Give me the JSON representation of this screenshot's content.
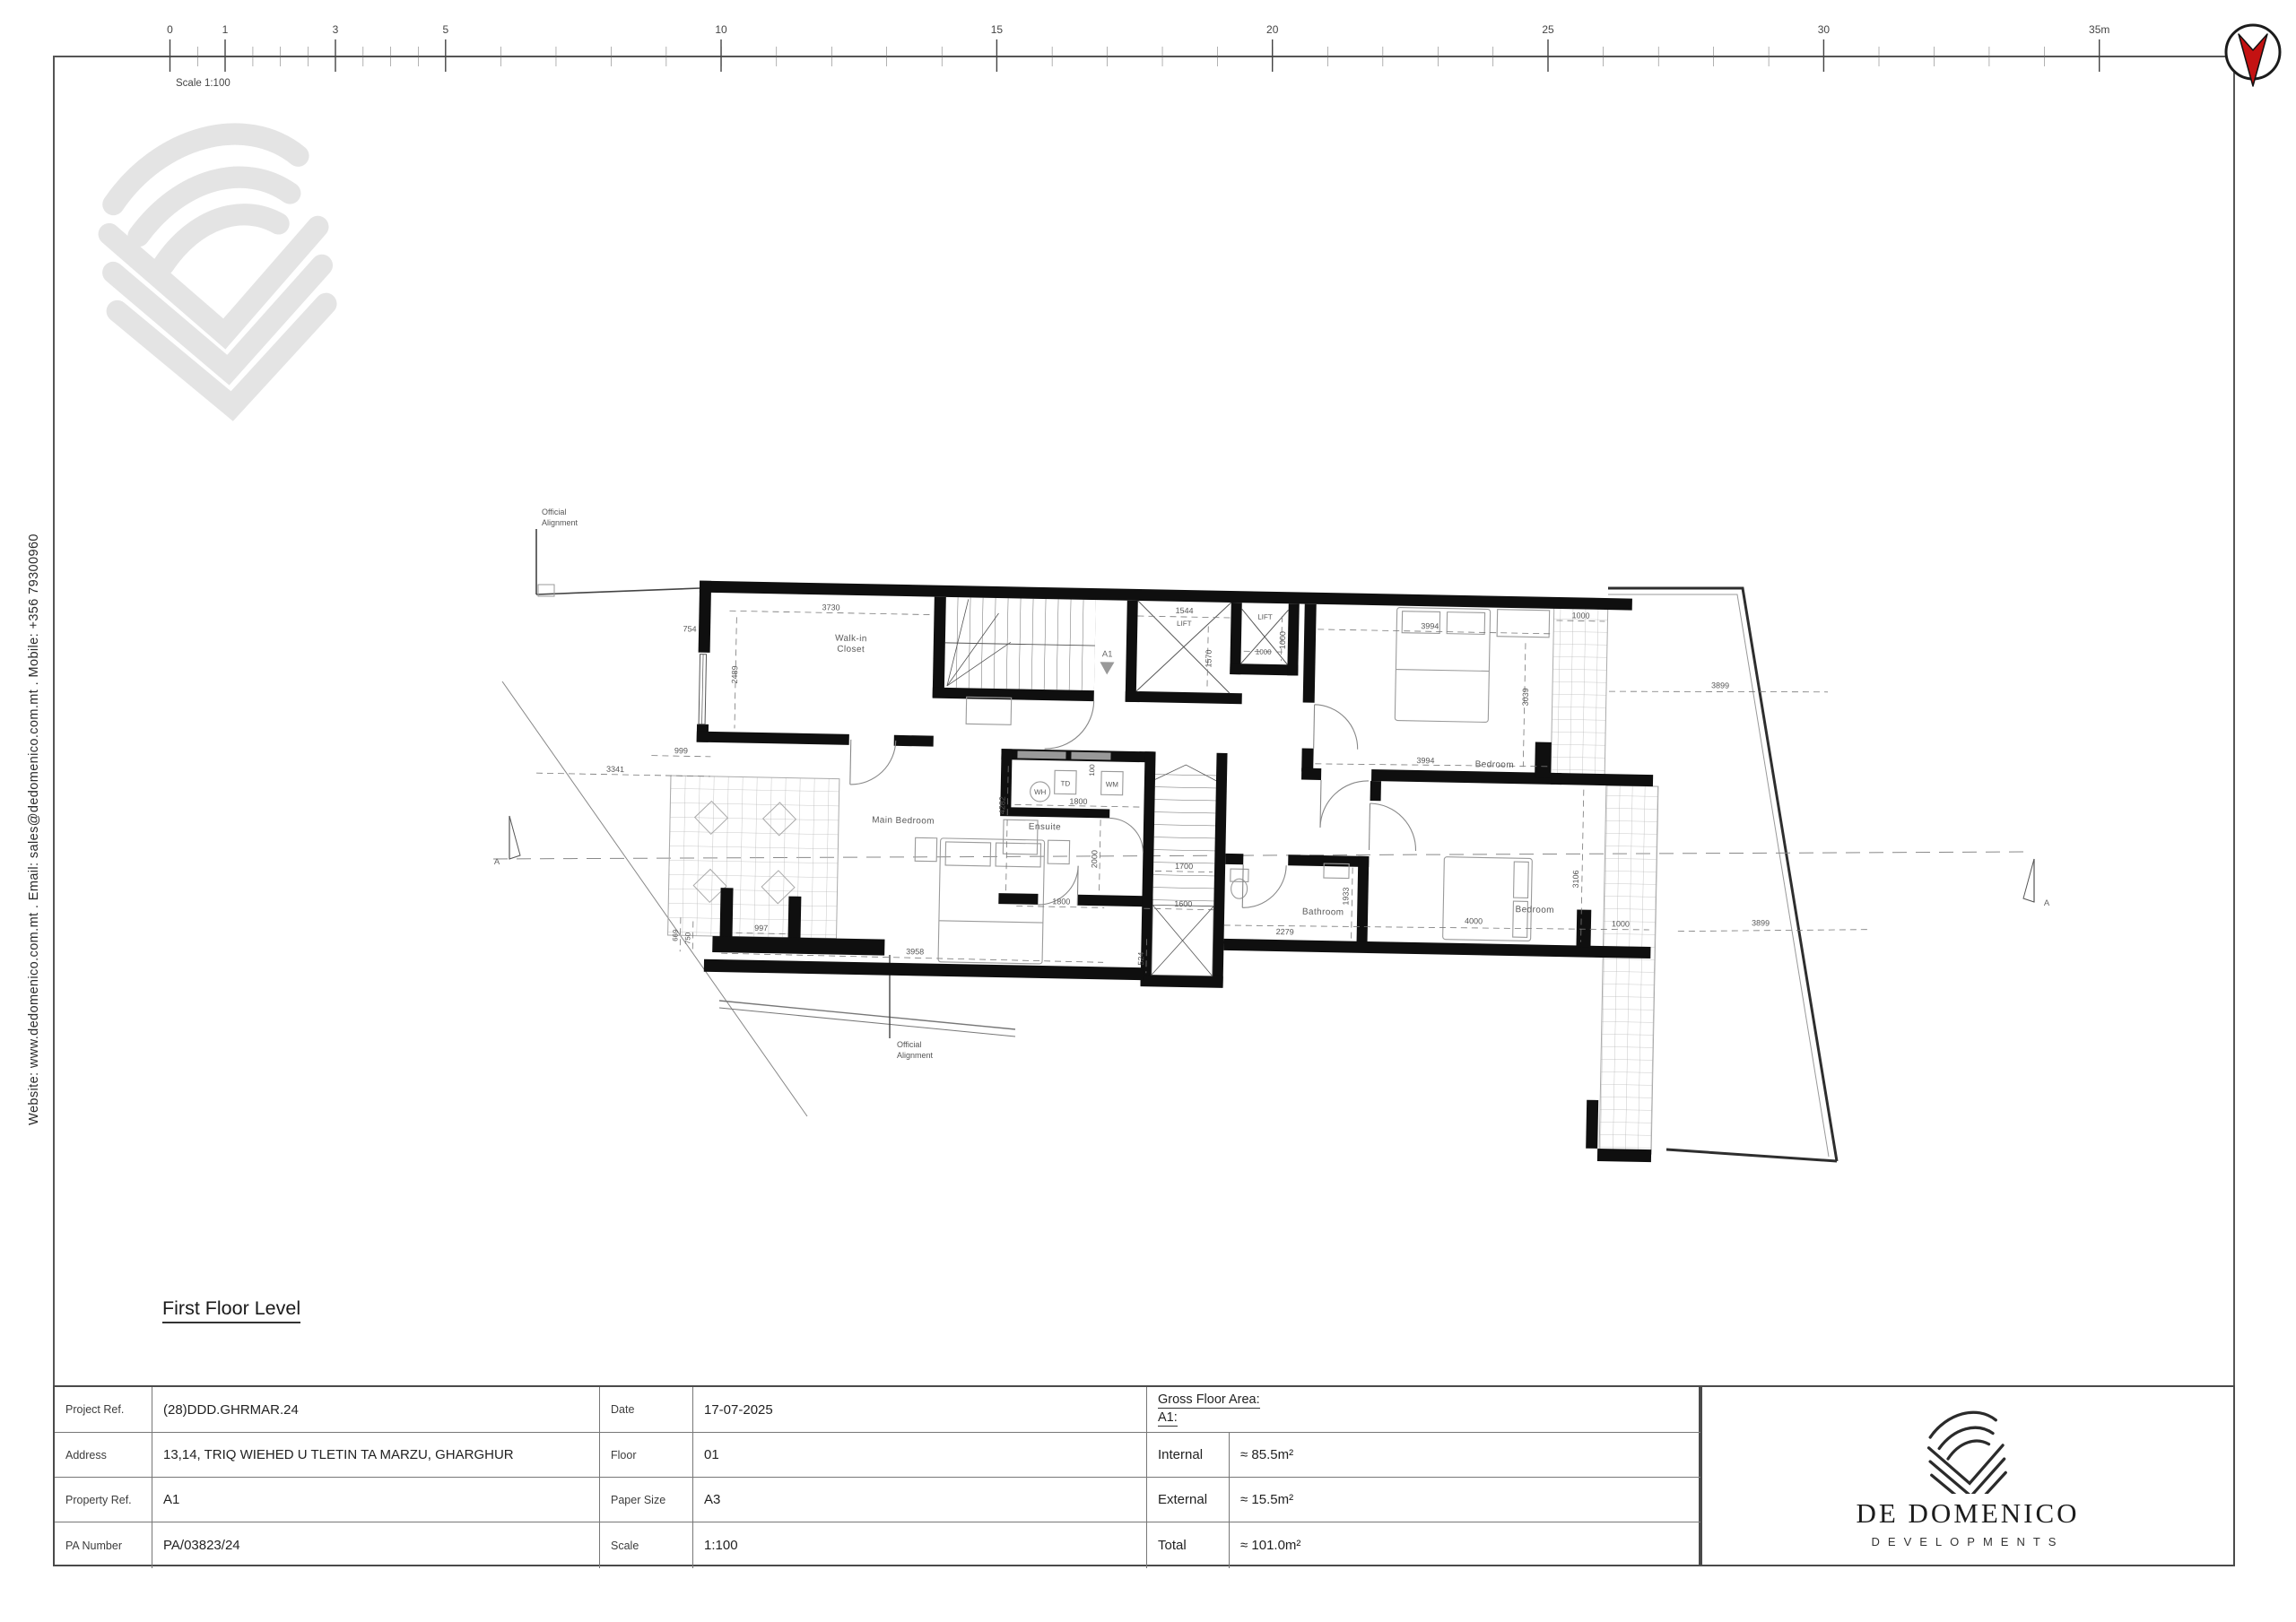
{
  "sheet": {
    "scale_label": "Scale 1:100",
    "ruler_labels": [
      "0",
      "1",
      "3",
      "5",
      "10",
      "15",
      "20",
      "25",
      "30",
      "35m"
    ],
    "contact_line": "Website: www.dedomenico.com.mt   .   Email: sales@dedomenico.com.mt   .   Mobile: +356 79300960",
    "drawing_title": "First Floor Level"
  },
  "plan": {
    "rooms": {
      "walk_in_closet_l1": "Walk-in",
      "walk_in_closet_l2": "Closet",
      "main_bedroom": "Main Bedroom",
      "ensuite": "Ensuite",
      "bathroom": "Bathroom",
      "bedroom_top": "Bedroom",
      "bedroom_bottom": "Bedroom",
      "lift1": "LIFT",
      "lift2": "LIFT",
      "wh": "WH",
      "td": "TD",
      "wm": "WM"
    },
    "markers": {
      "a1": "A1",
      "section_left": "A",
      "section_right": "A",
      "official_alignment_l1": "Official",
      "official_alignment_l2": "Alignment"
    },
    "dims": {
      "d3730": "3730",
      "d754": "754",
      "d2489": "2489",
      "d999": "999",
      "d3341": "3341",
      "d1544": "1544",
      "d1570": "1570",
      "d1000a": "1000",
      "d1000b": "1000",
      "d3994a": "3994",
      "d3039": "3039",
      "d1000c": "1000",
      "d3899a": "3899",
      "d3994b": "3994",
      "d4282": "4282",
      "d1800a": "1800",
      "d100": "100",
      "d2000": "2000",
      "d1700": "1700",
      "d1600": "1600",
      "d1800b": "1800",
      "d524": "524",
      "d3958": "3958",
      "d997": "997",
      "d750": "750",
      "d669": "669",
      "d2279": "2279",
      "d1933": "1933",
      "d4000": "4000",
      "d1000d": "1000",
      "d3106": "3106",
      "d3899b": "3899"
    }
  },
  "title_block": {
    "rows": [
      {
        "label": "Project Ref.",
        "value": "(28)DDD.GHRMAR.24",
        "label2": "Date",
        "value2": "17-07-2025"
      },
      {
        "label": "Address",
        "value": "13,14, TRIQ WIEHED U TLETIN TA MARZU, GHARGHUR",
        "label2": "Floor",
        "value2": "01"
      },
      {
        "label": "Property Ref.",
        "value": "A1",
        "label2": "Paper Size",
        "value2": "A3"
      },
      {
        "label": "PA Number",
        "value": "PA/03823/24",
        "label2": "Scale",
        "value2": "1:100"
      }
    ],
    "gfa": {
      "header_line1": "Gross Floor Area:",
      "header_line2": "A1:",
      "rows": [
        {
          "label": "Internal",
          "value": "≈ 85.5m²"
        },
        {
          "label": "External",
          "value": "≈ 15.5m²"
        },
        {
          "label": "Total",
          "value": "≈ 101.0m²"
        }
      ]
    }
  },
  "brand": {
    "name": "DE DOMENICO",
    "tagline": "DEVELOPMENTS"
  }
}
